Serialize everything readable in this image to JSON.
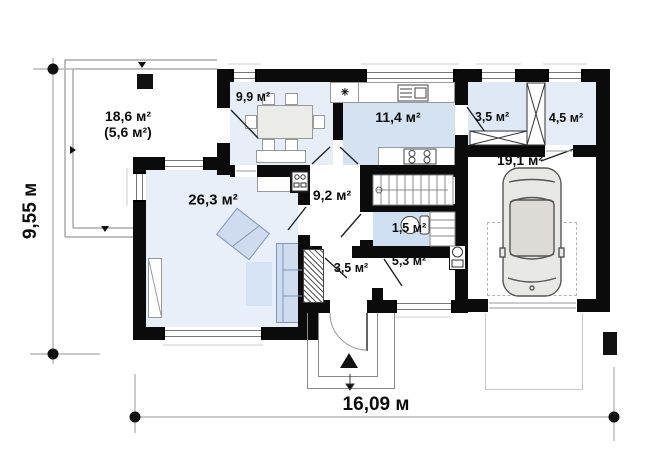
{
  "plan_title": "first-floor-plan",
  "dimensions": {
    "height_label": "9,55 м",
    "width_label": "16,09 м"
  },
  "rooms": {
    "terrace": {
      "area": "18,6 м²",
      "area_secondary": "(5,6 м²)"
    },
    "dining": {
      "area": "9,9 м²"
    },
    "kitchen": {
      "area": "11,4 м²"
    },
    "wardrobe": {
      "area": "3,5 м²"
    },
    "entry": {
      "area": "4,5 м²"
    },
    "garage": {
      "area": "19,1 м²"
    },
    "living": {
      "area": "26,3 м²"
    },
    "hall": {
      "area": "9,2 м²"
    },
    "wc": {
      "area": "1,5 м²"
    },
    "corridor": {
      "area": "3,5 м²"
    },
    "utility": {
      "area": "5,3 м²"
    }
  },
  "symbols": {
    "boiler_mark": "✳"
  },
  "colors": {
    "wall": "#0b0b0b",
    "room_light_blue": "#e9eff8",
    "room_medium_blue": "#d5e2f2",
    "furniture_blue": "#cfdcf0",
    "dimension_line": "#aaaaaa"
  }
}
